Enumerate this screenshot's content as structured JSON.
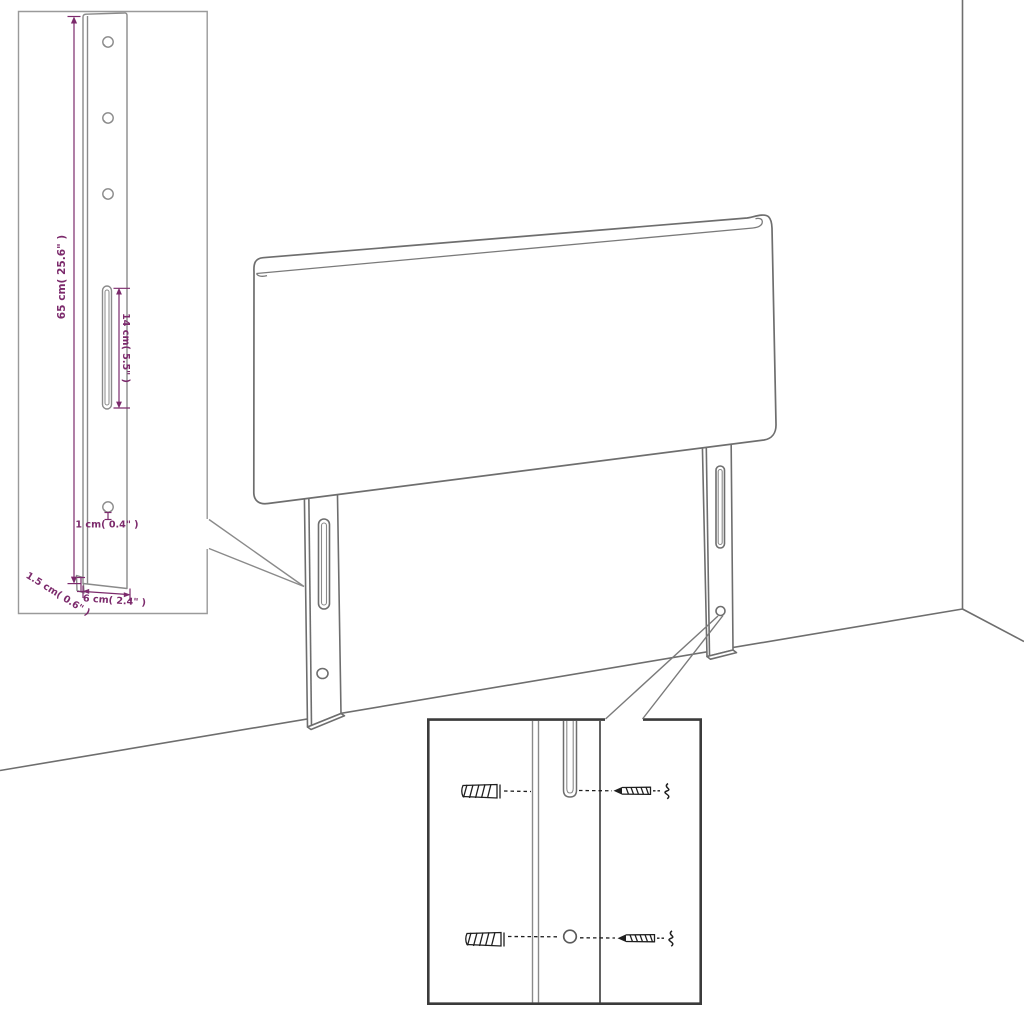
{
  "figure": {
    "kind": "product-dimension-line-drawing"
  },
  "colors": {
    "background": "#ffffff",
    "outline": "#6e6e6e",
    "inset_border_light": "#9a9a9a",
    "inset_border_dark": "#3b3b3b",
    "dimension": "#7c2a6c",
    "hardware": "#1f1f1f"
  },
  "bracket_inset": {
    "dim_height": "65 cm( 25.6\" )",
    "dim_slot": "14 cm( 5.5\" )",
    "dim_hole": "1 cm( 0.4\" )",
    "dim_thickness": "1.5 cm( 0.6\" )",
    "dim_width": "6 cm( 2.4\" )"
  },
  "hardware_inset": {
    "icons": [
      "wall-anchor-icon",
      "wall-anchor-icon",
      "screw-icon",
      "screw-icon"
    ]
  }
}
